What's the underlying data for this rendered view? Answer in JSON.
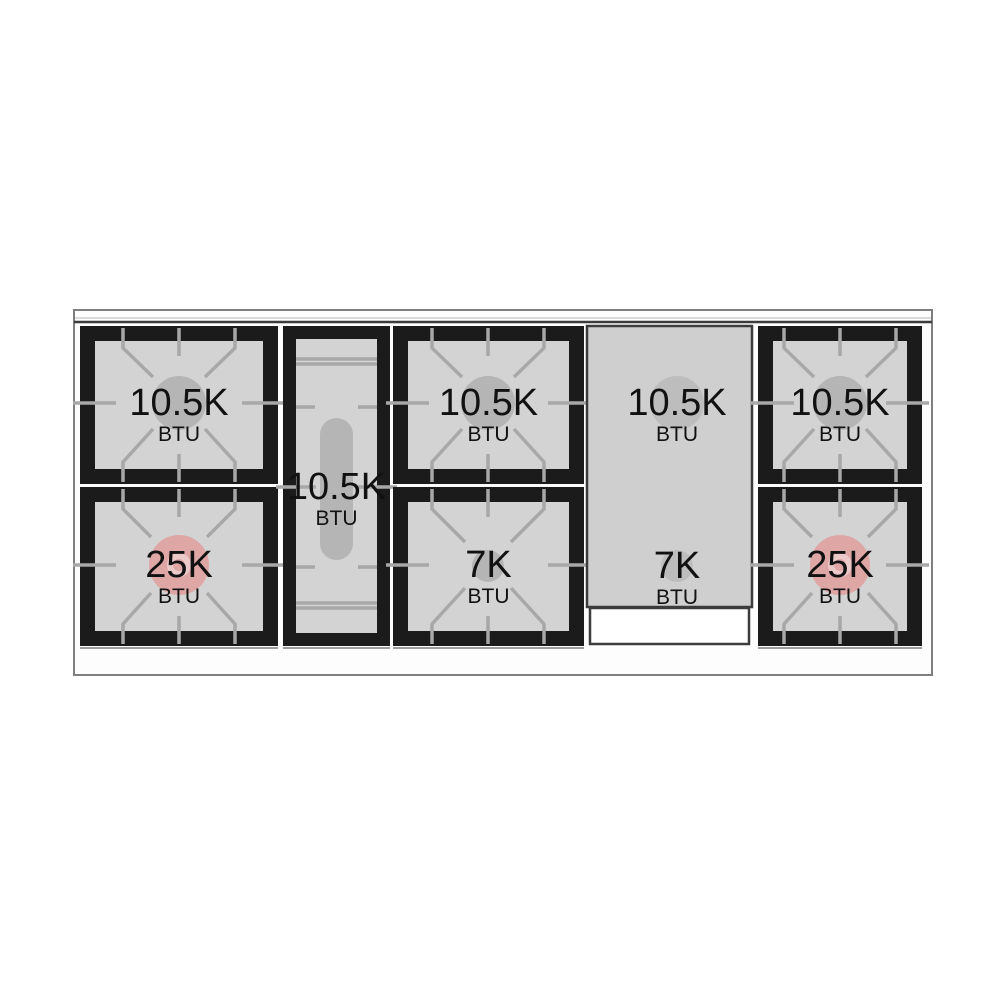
{
  "diagram": {
    "colors": {
      "surface": "#fdfdfd",
      "outline": "#7f7f7f",
      "line-light": "#cfcfcf",
      "line-dark": "#3c3c3c",
      "shadow": "#9c9c9c",
      "grate-frame": "#1b1b1b",
      "burner-bed": "#d3d3d3",
      "grate-line": "#a8a8a8",
      "burner-cap": "#b5b5b5",
      "griddle": "#cfcfcf",
      "griddle-cap": "#bdbdbd",
      "power-burner": "#dfa6a6",
      "power-burner-light": "#ecc9c9",
      "text": "#111111"
    },
    "burners": [
      {
        "id": "rear-left",
        "value": "10.5K",
        "unit": "BTU"
      },
      {
        "id": "front-left",
        "value": "25K",
        "unit": "BTU"
      },
      {
        "id": "center-oval",
        "value": "10.5K",
        "unit": "BTU"
      },
      {
        "id": "rear-center",
        "value": "10.5K",
        "unit": "BTU"
      },
      {
        "id": "front-center",
        "value": "7K",
        "unit": "BTU"
      },
      {
        "id": "griddle-rear",
        "value": "10.5K",
        "unit": "BTU"
      },
      {
        "id": "griddle-front",
        "value": "7K",
        "unit": "BTU"
      },
      {
        "id": "rear-right",
        "value": "10.5K",
        "unit": "BTU"
      },
      {
        "id": "front-right",
        "value": "25K",
        "unit": "BTU"
      }
    ]
  }
}
